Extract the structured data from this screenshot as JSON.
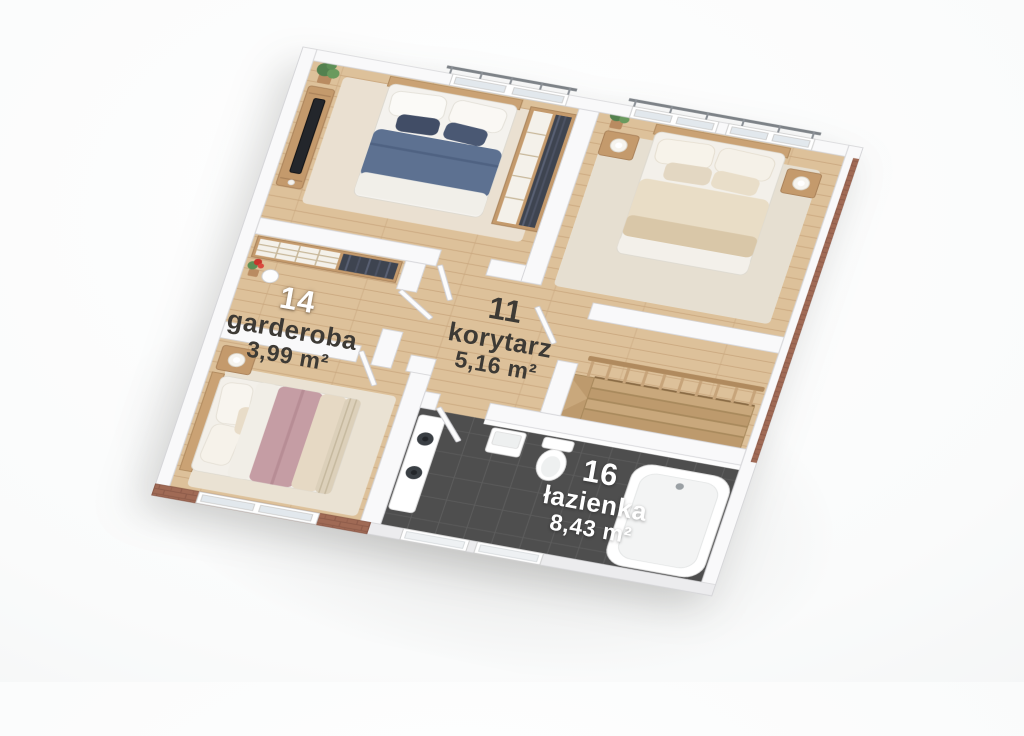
{
  "scene": {
    "type": "3d-floor-plan-render",
    "view": "isometric-top",
    "background": "#ffffff"
  },
  "rooms": [
    {
      "key": "garderoba",
      "number": "14",
      "name": "garderoba",
      "area": "3,99 m²",
      "floor": "wood",
      "features": [
        "shelving-unit",
        "folded-clothes",
        "hanging-clothes",
        "red-flower-pot",
        "round-mirror"
      ]
    },
    {
      "key": "korytarz",
      "number": "11",
      "name": "korytarz",
      "area": "5,16 m²",
      "floor": "wood",
      "features": [
        "open-doors"
      ]
    },
    {
      "key": "lazienka",
      "number": "16",
      "name": "łazienka",
      "area": "8,43 m²",
      "floor": "dark-tile",
      "features": [
        "bathtub",
        "toilet",
        "vanity-two-sinks",
        "laundry-box",
        "frosted-windows"
      ]
    },
    {
      "key": "bedroom-north",
      "number": "",
      "name": "",
      "area": "",
      "floor": "wood",
      "features": [
        "double-bed-navy",
        "tv-console",
        "tv",
        "wardrobe-closet",
        "potted-plant",
        "balcony-door",
        "rug"
      ]
    },
    {
      "key": "bedroom-east",
      "number": "",
      "name": "",
      "area": "",
      "floor": "wood",
      "features": [
        "double-bed-beige",
        "nightstand-left",
        "nightstand-right",
        "ball-lamps",
        "potted-plant",
        "balcony-windows",
        "rug"
      ]
    },
    {
      "key": "bedroom-west",
      "number": "",
      "name": "",
      "area": "",
      "floor": "wood",
      "features": [
        "double-bed-mauve",
        "nightstand",
        "lamp",
        "window-in-brick-wall",
        "rug"
      ]
    },
    {
      "key": "staircase-landing",
      "number": "",
      "name": "",
      "area": "",
      "floor": "wood",
      "features": [
        "wood-railing-balusters",
        "descending-stairs"
      ]
    }
  ],
  "palette": {
    "wall": "#f9f9fa",
    "wall_stroke": "#d6d6d9",
    "floor_wood": "#ddc19a",
    "floor_wood_seam": "#b4834f",
    "bathroom_tile": "#4e4e4e",
    "bathroom_tile_seam": "#5c5c5c",
    "brick": "#a06a55",
    "brick_seam": "#8b5948",
    "bed_navy": "#5d7191",
    "bed_beige": "#e9ddc6",
    "bed_mauve": "#c59da4",
    "wood_furniture": "#c49a6c",
    "railing_wood": "#b08a5e",
    "label_dark": "#3d3a35",
    "label_light": "#ffffff",
    "glass": "#e2e8ed"
  }
}
